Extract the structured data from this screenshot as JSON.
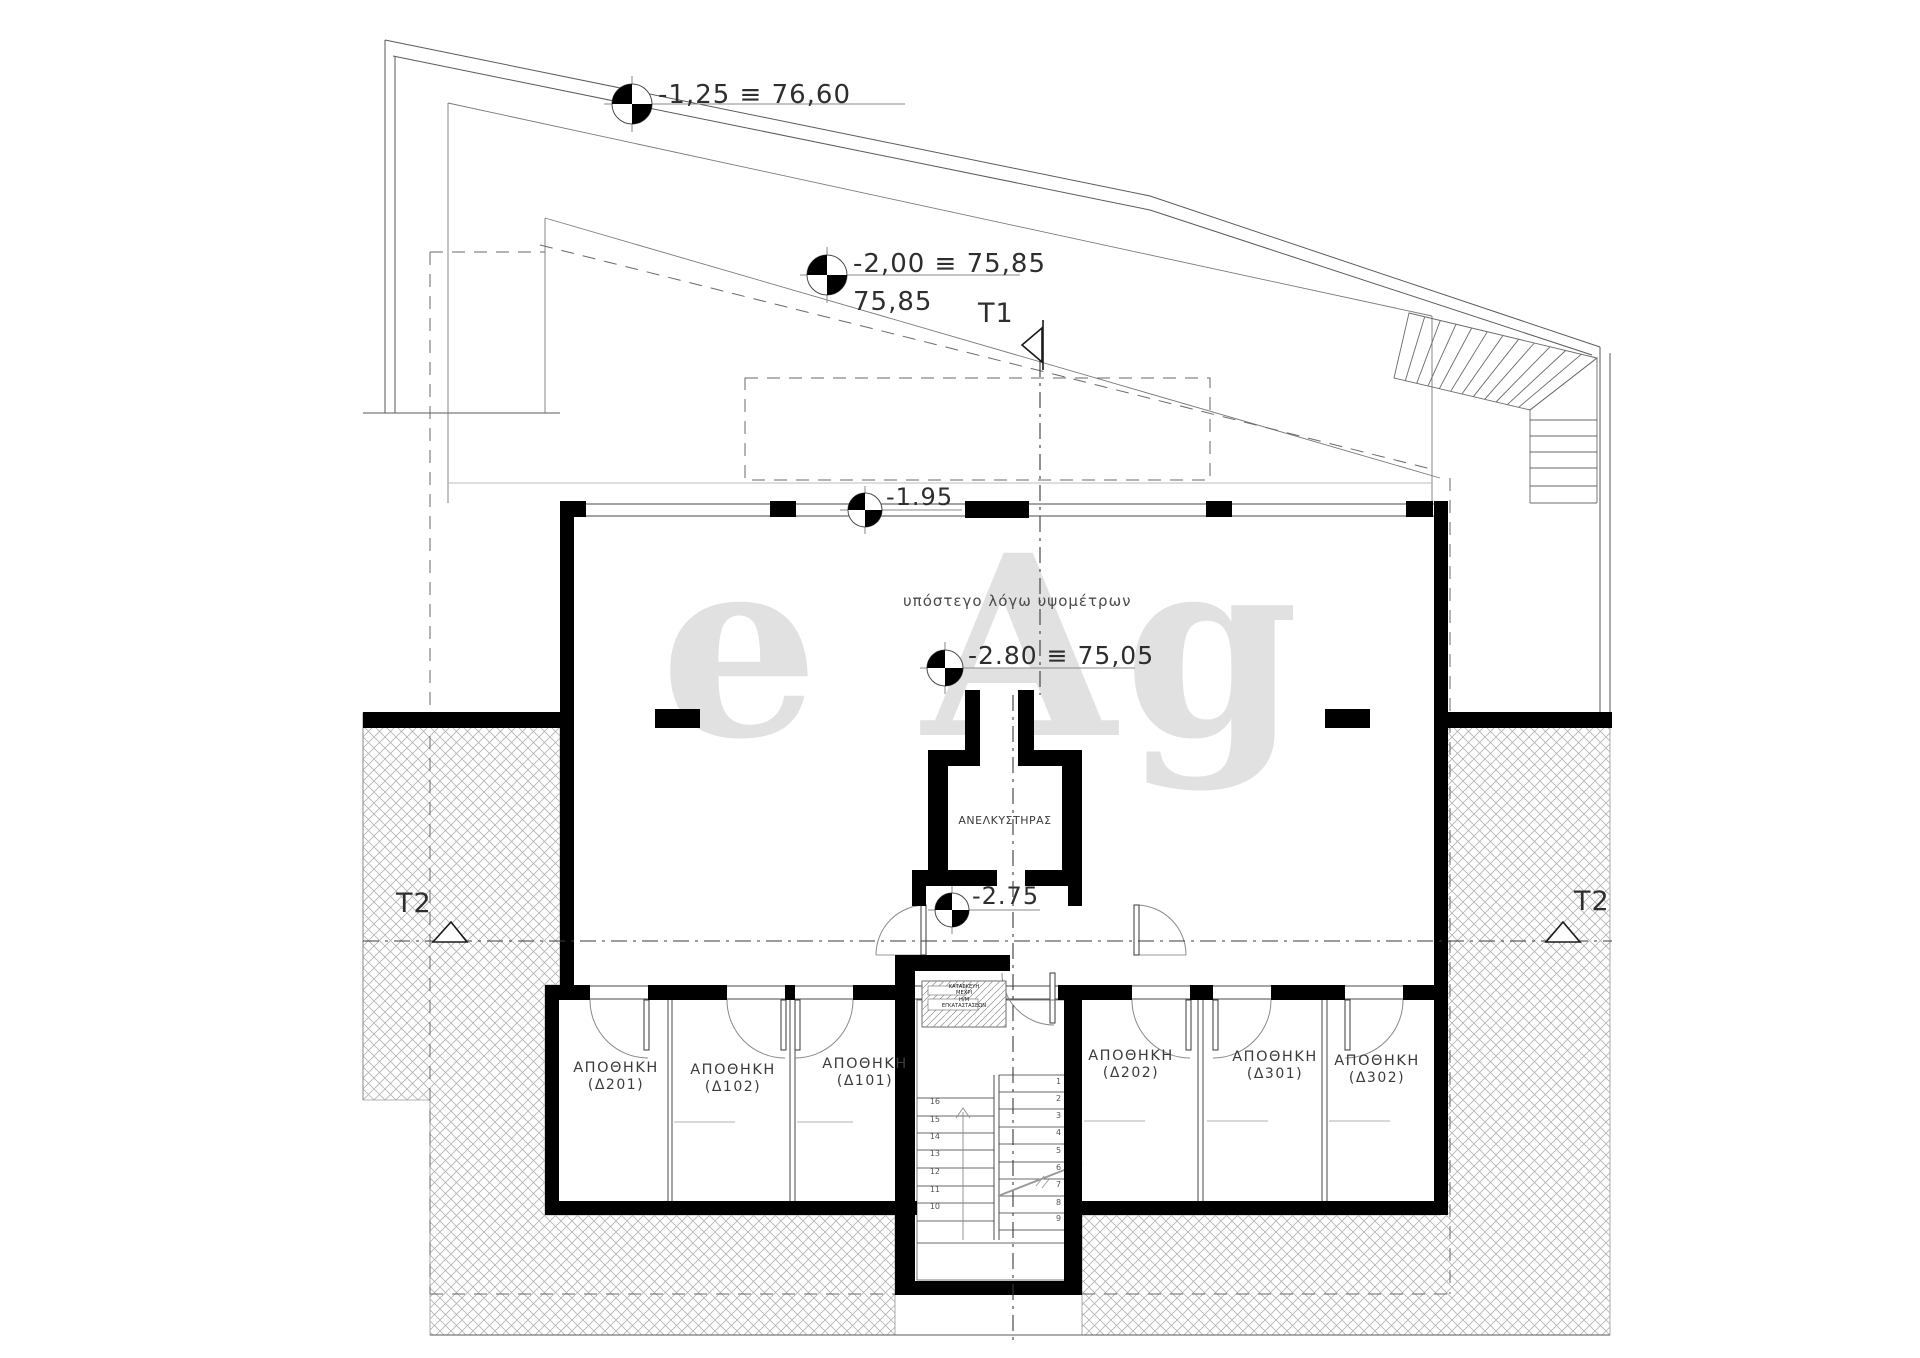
{
  "plan": {
    "markers": [
      {
        "label": "-1,25 ≡ 76,60"
      },
      {
        "label": "-2,00 ≡ 75,85",
        "sublabel": "75,85"
      },
      {
        "label": "-1.95"
      },
      {
        "label": "-2.80 ≡ 75,05"
      },
      {
        "label": "-2.75"
      }
    ],
    "sections": {
      "t1": "T1",
      "t2_left": "T2",
      "t2_right": "T2"
    },
    "texts": {
      "canopy_note": "υπόστεγο λόγω υψομέτρων",
      "elevator": "ΑΝΕΛΚΥΣΤΗΡΑΣ",
      "shaft_note": [
        "ΚΑΤΑΣΚΕΥΗ",
        "ΜΕΧΡΙ",
        "Η/Μ",
        "ΕΓΚΑΤΑΣΤΑΣΕΩΝ"
      ],
      "watermark": "e Ag"
    },
    "rooms": [
      {
        "line1": "ΑΠΟΘΗΚΗ",
        "line2": "(Δ201)"
      },
      {
        "line1": "ΑΠΟΘΗΚΗ",
        "line2": "(Δ102)"
      },
      {
        "line1": "ΑΠΟΘΗΚΗ",
        "line2": "(Δ101)"
      },
      {
        "line1": "ΑΠΟΘΗΚΗ",
        "line2": "(Δ202)"
      },
      {
        "line1": "ΑΠΟΘΗΚΗ",
        "line2": "(Δ301)"
      },
      {
        "line1": "ΑΠΟΘΗΚΗ",
        "line2": "(Δ302)"
      }
    ],
    "stair": {
      "left_numbers": [
        "16",
        "15",
        "14",
        "13",
        "12",
        "11",
        "10"
      ],
      "right_numbers": [
        "1",
        "2",
        "3",
        "4",
        "5",
        "6",
        "7",
        "8",
        "9"
      ]
    },
    "colors": {
      "wall": "#000000",
      "line": "#4a4a4a",
      "light_line": "#9a9a9a",
      "hatch": "#b3b3b3",
      "text": "#2e2e2e",
      "watermark": "#c9c9c9"
    }
  }
}
